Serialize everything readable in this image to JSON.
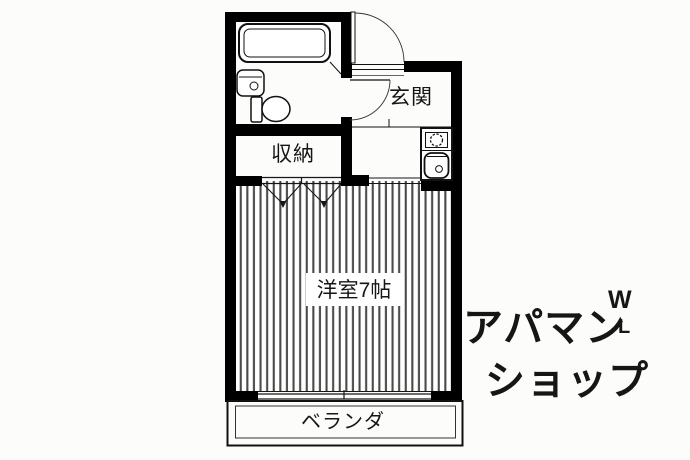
{
  "colors": {
    "background": "#fcfcfa",
    "wall": "#000000",
    "line": "#161616",
    "floor_stripe": "#4a4a4a",
    "watermark": "#e8e8e6"
  },
  "floorplan": {
    "rooms": {
      "entrance": {
        "label": "玄関"
      },
      "storage": {
        "label": "収納"
      },
      "western_room": {
        "label": "洋室7帖"
      },
      "balcony": {
        "label": "ベランダ"
      }
    },
    "fixtures": {
      "bathtub": "bathtub",
      "washbasin": "washbasin",
      "toilet": "toilet",
      "entrance_door": "entrance-swing-door",
      "bathroom_door": "bathroom-swing-door",
      "stove_burner": "single-burner-stove",
      "kitchen_sink": "kitchen-sink",
      "closet_doors": "bi-fold-closet-doors",
      "window": "sliding-window",
      "flooring": "wood-flooring-stripes"
    }
  },
  "watermark": {
    "line1": "アパマン",
    "line2": "ショップ",
    "mark_top": "W",
    "mark_bottom": "L"
  }
}
